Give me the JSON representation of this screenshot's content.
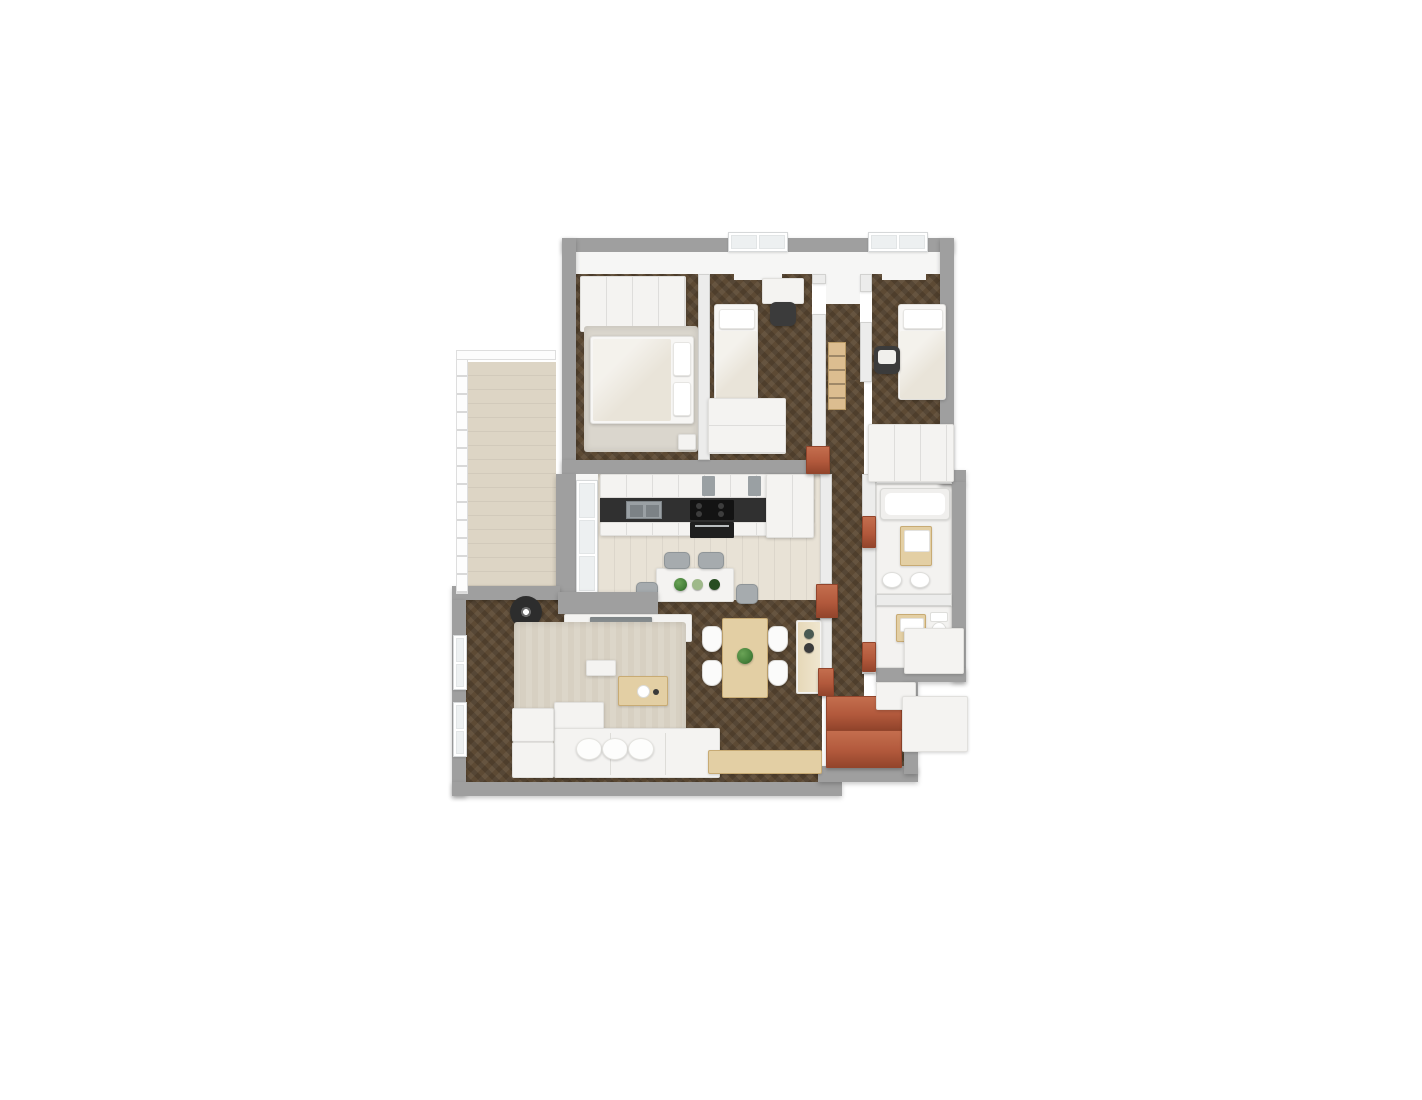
{
  "scene": {
    "kind": "3d-floor-plan-render",
    "view": "top-down",
    "background": "#ffffff",
    "text_on_image": "none"
  },
  "palette": {
    "wall_gray": "#9f9f9f",
    "wall_face": "#f6f6f5",
    "interior_wall": "#ececeb",
    "parquet": "#5d4a34",
    "kitchen_floor": "#e8e2d6",
    "balcony_floor": "#ddd5c5",
    "bath_floor": "#f3f2f0",
    "rug": "#d7d0c2",
    "rug_bedroom": "#dad6cd",
    "white_furn": "#f4f3f1",
    "wood": "#e3cfa4",
    "counter": "#303030",
    "steel": "#9aa0a4",
    "terracotta": "#b2593c",
    "terracotta_dark": "#93452c",
    "plant": "#47823b",
    "chair_gray": "#a6abae",
    "tv_gray": "#8d9294",
    "lamp": "#2d2d2d",
    "linen": "#e9e4d9"
  },
  "rooms": [
    {
      "name": "master-bedroom",
      "floor": "dark-parquet",
      "furniture": [
        "wardrobe",
        "double-bed",
        "pillows",
        "rug",
        "nightstand"
      ]
    },
    {
      "name": "bedroom-2",
      "floor": "dark-parquet",
      "furniture": [
        "single-bed",
        "desk",
        "desk-chair",
        "dresser",
        "radiator"
      ]
    },
    {
      "name": "bedroom-3",
      "floor": "dark-parquet",
      "furniture": [
        "single-bed",
        "desk-chair",
        "wardrobe",
        "radiator"
      ]
    },
    {
      "name": "hallway",
      "floor": "dark-parquet-herringbone",
      "furniture": [
        "wood-shelf",
        "terracotta-door-frames",
        "terracotta-entry-closet"
      ]
    },
    {
      "name": "kitchen",
      "floor": "light-plank",
      "furniture": [
        "upper-cabinets",
        "dark-counter",
        "double-sink",
        "cooktop",
        "oven",
        "tall-units",
        "island-table",
        "bar-chairs",
        "potted-plants"
      ]
    },
    {
      "name": "living-room",
      "floor": "dark-parquet",
      "furniture": [
        "tv-partition",
        "tv-sideboard",
        "tv",
        "floor-lamp",
        "side-table",
        "rug",
        "tray-stool",
        "coffee-table",
        "corner-sofa",
        "sofa-cushions",
        "ottomans"
      ]
    },
    {
      "name": "dining-area",
      "floor": "dark-parquet",
      "furniture": [
        "dining-table",
        "four-chairs",
        "table-plant",
        "sideboard",
        "dark-pots",
        "wall-bench"
      ]
    },
    {
      "name": "bathroom",
      "floor": "white-tile",
      "furniture": [
        "bathtub",
        "wood-vanity-sink",
        "toilet",
        "bidet"
      ]
    },
    {
      "name": "wc",
      "floor": "white-tile",
      "furniture": [
        "wood-sink",
        "toilet",
        "washing-column",
        "storage-block"
      ]
    },
    {
      "name": "balcony",
      "floor": "beige-tile",
      "furniture": [
        "glass-railing"
      ]
    }
  ],
  "windows": [
    "bedroom-2-top-window",
    "bedroom-3-top-window",
    "living-left-window-1",
    "living-left-window-2",
    "balcony-glass-door"
  ]
}
